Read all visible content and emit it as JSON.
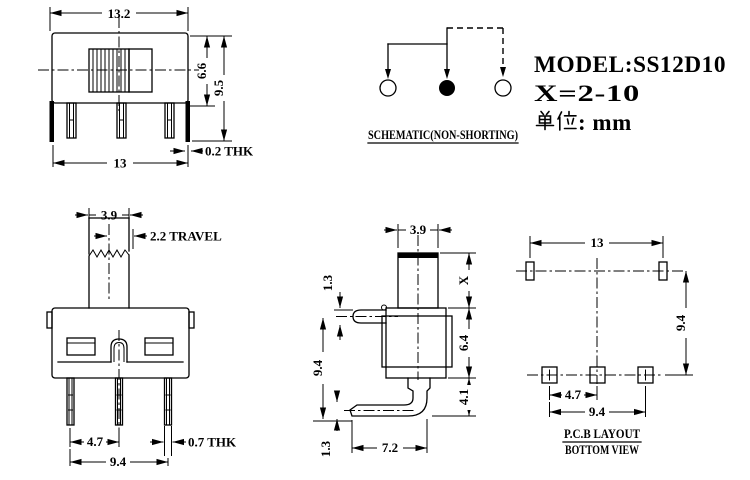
{
  "info": {
    "model": "MODEL:SS12D10",
    "x_range": "X=2-10",
    "unit_cjk": "单位",
    "unit_suffix": ": mm"
  },
  "schematic": {
    "caption": "SCHEMATIC(NON-SHORTING)"
  },
  "front_view": {
    "width_top": "13.2",
    "height_inner": "6.6",
    "height_overall": "9.5",
    "width_bottom": "13",
    "bracket_thickness": "0.2 THK"
  },
  "end_view": {
    "knob_width": "3.9",
    "travel": "2.2 TRAVEL",
    "pin_pitch": "4.7",
    "pin_thickness": "0.7 THK",
    "pin_span": "9.4"
  },
  "side_view": {
    "knob_width": "3.9",
    "knob_height": "X",
    "lug_thickness": "1.3",
    "body_height": "6.4",
    "overall_height": "9.4",
    "pin_drop": "4.1",
    "pin_lip": "1.3",
    "pin_reach": "7.2"
  },
  "pcb_view": {
    "mount_span": "13",
    "row_spacing": "9.4",
    "pad_pitch": "4.7",
    "pad_span": "9.4",
    "caption1": "P.C.B LAYOUT",
    "caption2": "BOTTOM VIEW"
  }
}
